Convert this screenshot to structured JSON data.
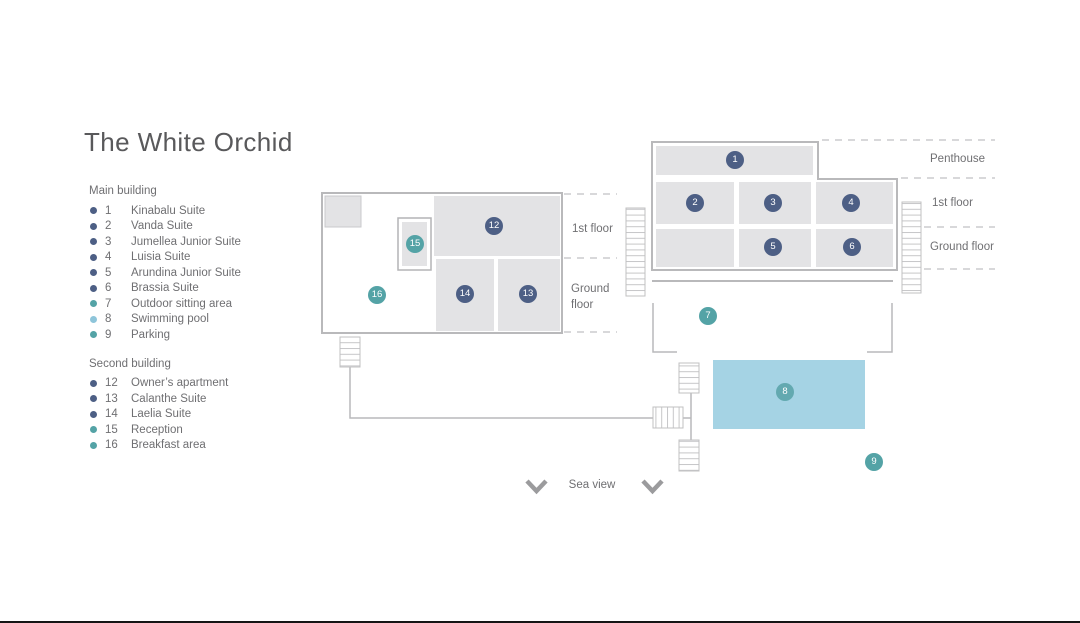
{
  "title": "The White Orchid",
  "legend": {
    "sections": [
      {
        "heading": "Main building",
        "items": [
          {
            "num": "1",
            "label": "Kinabalu Suite",
            "color": "dark"
          },
          {
            "num": "2",
            "label": "Vanda Suite",
            "color": "dark"
          },
          {
            "num": "3",
            "label": "Jumellea Junior Suite",
            "color": "dark"
          },
          {
            "num": "4",
            "label": "Luisia Suite",
            "color": "dark"
          },
          {
            "num": "5",
            "label": "Arundina Junior Suite",
            "color": "dark"
          },
          {
            "num": "6",
            "label": "Brassia Suite",
            "color": "dark"
          },
          {
            "num": "7",
            "label": "Outdoor sitting area",
            "color": "teal"
          },
          {
            "num": "8",
            "label": "Swimming pool",
            "color": "pool"
          },
          {
            "num": "9",
            "label": "Parking",
            "color": "teal"
          }
        ]
      },
      {
        "heading": "Second building",
        "items": [
          {
            "num": "12",
            "label": "Owner’s apartment",
            "color": "dark"
          },
          {
            "num": "13",
            "label": "Calanthe Suite",
            "color": "dark"
          },
          {
            "num": "14",
            "label": "Laelia Suite",
            "color": "dark"
          },
          {
            "num": "15",
            "label": "Reception",
            "color": "teal"
          },
          {
            "num": "16",
            "label": "Breakfast area",
            "color": "teal"
          }
        ]
      }
    ]
  },
  "plan": {
    "main_building": {
      "floor_labels": [
        "Penthouse",
        "1st floor",
        "Ground floor"
      ]
    },
    "second_building": {
      "floor_labels": [
        "1st floor",
        "Ground floor"
      ]
    },
    "sea_view_label": "Sea view",
    "badges": [
      {
        "num": "1"
      },
      {
        "num": "2"
      },
      {
        "num": "3"
      },
      {
        "num": "4"
      },
      {
        "num": "5"
      },
      {
        "num": "6"
      },
      {
        "num": "7"
      },
      {
        "num": "8"
      },
      {
        "num": "9"
      },
      {
        "num": "12"
      },
      {
        "num": "13"
      },
      {
        "num": "14"
      },
      {
        "num": "15"
      },
      {
        "num": "16"
      }
    ]
  },
  "colors": {
    "dark_unit_badge": "#4d5f85",
    "teal_area_badge": "#54a3a6",
    "pool_fill": "#a5d3e4",
    "pool_legend_dot": "#8ec5da",
    "pool_badge": "#63a9b0",
    "room_fill": "#e3e3e5",
    "building_outline": "#b9b9bb",
    "dashed_line": "#cbcbcd",
    "text": "#6f6f72",
    "title_text": "#59595b"
  }
}
